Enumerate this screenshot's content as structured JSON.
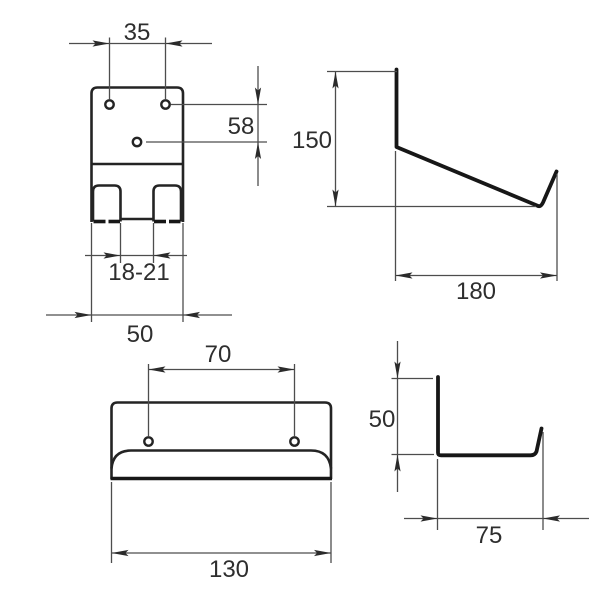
{
  "document": {
    "kind": "technical-dimension-drawing",
    "background_color": "#ffffff",
    "outline_color": "#242424",
    "profile_color": "#171717",
    "dimension_line_color": "#4d4d4d",
    "label_color": "#2e2e2e"
  },
  "views": {
    "hook_front": {
      "dims": {
        "hole_spacing": "35",
        "hole_offset": "58",
        "slot_width": "18-21",
        "width": "50"
      }
    },
    "hook_side": {
      "dims": {
        "height": "150",
        "depth": "180"
      }
    },
    "tray_front": {
      "dims": {
        "hole_spacing": "70",
        "width": "130"
      }
    },
    "tray_side": {
      "dims": {
        "height": "50",
        "depth": "75"
      }
    }
  }
}
